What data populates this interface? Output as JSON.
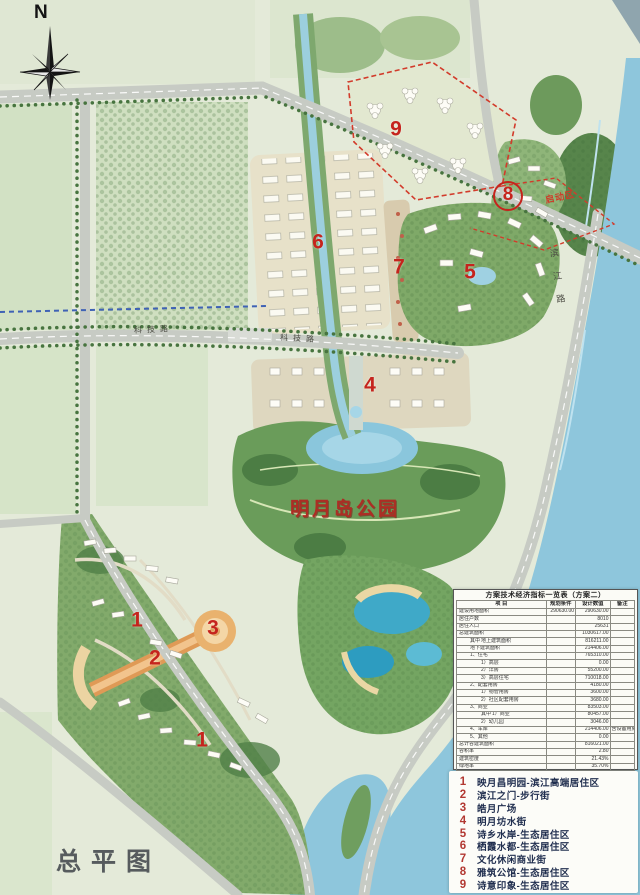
{
  "sheet": {
    "title": "总平图"
  },
  "compass": {
    "north_label": "N"
  },
  "map": {
    "park_label": "明月岛公园",
    "startup_zone_label": "启动区",
    "road_labels": [
      {
        "text": "科技路",
        "x": 134,
        "y": 324,
        "rot": -3,
        "vertical": false
      },
      {
        "text": "科技路",
        "x": 280,
        "y": 333,
        "rot": 3,
        "vertical": false
      },
      {
        "text": "滨江路",
        "x": 552,
        "y": 248,
        "rot": -8,
        "vertical": true
      }
    ],
    "markers": [
      {
        "n": "9",
        "x": 396,
        "y": 129,
        "circled": false
      },
      {
        "n": "8",
        "x": 508,
        "y": 196,
        "circled": true
      },
      {
        "n": "6",
        "x": 318,
        "y": 242,
        "circled": false
      },
      {
        "n": "7",
        "x": 399,
        "y": 267,
        "circled": false
      },
      {
        "n": "5",
        "x": 470,
        "y": 272,
        "circled": false
      },
      {
        "n": "4",
        "x": 370,
        "y": 385,
        "circled": false
      },
      {
        "n": "1",
        "x": 137,
        "y": 620,
        "circled": false
      },
      {
        "n": "3",
        "x": 213,
        "y": 628,
        "circled": false
      },
      {
        "n": "2",
        "x": 155,
        "y": 658,
        "circled": false
      },
      {
        "n": "1",
        "x": 202,
        "y": 740,
        "circled": false
      }
    ]
  },
  "legend": {
    "items": [
      {
        "num": "1",
        "label": "映月昌明园-滨江高端居住区"
      },
      {
        "num": "2",
        "label": "滨江之门-步行街"
      },
      {
        "num": "3",
        "label": "皓月广场"
      },
      {
        "num": "4",
        "label": "明月坊水街"
      },
      {
        "num": "5",
        "label": "诗乡水岸-生态居住区"
      },
      {
        "num": "6",
        "label": "栖霞水都-生态居住区"
      },
      {
        "num": "7",
        "label": "文化休闲商业街"
      },
      {
        "num": "8",
        "label": "雅筑公馆-生态居住区"
      },
      {
        "num": "9",
        "label": "诗意印象-生态居住区"
      }
    ]
  },
  "table": {
    "title": "方案技术经济指标一览表（方案二）",
    "headers": [
      "项  目",
      "规划条件",
      "设计数值",
      "备注"
    ],
    "rows": [
      {
        "g": "",
        "l": "建设用地面积",
        "i": 0,
        "c": "290630.00",
        "v": "290630.00",
        "r": ""
      },
      {
        "g": "",
        "l": "居住户数",
        "i": 0,
        "c": "",
        "v": "8010",
        "r": ""
      },
      {
        "g": "",
        "l": "居住人口",
        "i": 0,
        "c": "",
        "v": "25631",
        "r": ""
      },
      {
        "g": "",
        "l": "总建筑面积",
        "i": 0,
        "c": "",
        "v": "1030617.00",
        "r": ""
      },
      {
        "g": "其中",
        "l": "地上建筑面积",
        "i": 1,
        "c": "",
        "v": "816211.00",
        "r": ""
      },
      {
        "g": "",
        "l": "地下建筑面积",
        "i": 1,
        "c": "",
        "v": "214406.00",
        "r": ""
      },
      {
        "g": "",
        "l": "1、住宅",
        "i": 1,
        "c": "",
        "v": "765310.00",
        "r": ""
      },
      {
        "g": "",
        "l": "1）高层",
        "i": 2,
        "c": "",
        "v": "0.00",
        "r": ""
      },
      {
        "g": "",
        "l": "2）洋房",
        "i": 2,
        "c": "",
        "v": "55200.00",
        "r": ""
      },
      {
        "g": "",
        "l": "3）高层住宅",
        "i": 2,
        "c": "",
        "v": "710018.00",
        "r": ""
      },
      {
        "g": "",
        "l": "2、配套用房",
        "i": 1,
        "c": "",
        "v": "4180.00",
        "r": ""
      },
      {
        "g": "",
        "l": "1）物管用房",
        "i": 2,
        "c": "",
        "v": "3600.00",
        "r": ""
      },
      {
        "g": "",
        "l": "2）社区配套用房",
        "i": 2,
        "c": "",
        "v": "3680.00",
        "r": ""
      },
      {
        "g": "",
        "l": "3、商业",
        "i": 1,
        "c": "",
        "v": "83503.00",
        "r": ""
      },
      {
        "g": "其中",
        "l": "1）商业",
        "i": 2,
        "c": "",
        "v": "80457.00",
        "r": ""
      },
      {
        "g": "",
        "l": "2）幼儿园",
        "i": 2,
        "c": "",
        "v": "3046.00",
        "r": ""
      },
      {
        "g": "",
        "l": "4、车库",
        "i": 1,
        "c": "",
        "v": "214406.00",
        "r": "含设备用房"
      },
      {
        "g": "",
        "l": "5、其他",
        "i": 1,
        "c": "",
        "v": "0.00",
        "r": ""
      },
      {
        "g": "",
        "l": "总计容建筑面积",
        "i": 0,
        "c": "",
        "v": "816021.00",
        "r": ""
      },
      {
        "g": "",
        "l": "容积率",
        "i": 0,
        "c": "",
        "v": "2.80",
        "r": ""
      },
      {
        "g": "",
        "l": "建筑密度",
        "i": 0,
        "c": "",
        "v": "21.43%",
        "r": ""
      },
      {
        "g": "",
        "l": "绿地率",
        "i": 0,
        "c": "",
        "v": "35.70%",
        "r": ""
      },
      {
        "g": "",
        "l": "停车位",
        "i": 0,
        "c": "",
        "v": "7890",
        "r": ""
      },
      {
        "g": "其中",
        "l": "1）地上",
        "i": 1,
        "c": "",
        "v": "890",
        "r": ""
      },
      {
        "g": "",
        "l": "2）地下",
        "i": 1,
        "c": "",
        "v": "7000",
        "r": ""
      },
      {
        "g": "",
        "l": "建筑高度（层数）",
        "i": 0,
        "c": "",
        "v": "99.9米",
        "r": ""
      }
    ]
  },
  "colors": {
    "accent_red": "#c5241d",
    "boundary_red": "#d23b2b",
    "legend_number": "#b23832",
    "legend_text": "#1f2d4e",
    "water": "#8ec6dc",
    "park_green": "#6a9c5a",
    "road_gray": "#c7cbc4"
  }
}
